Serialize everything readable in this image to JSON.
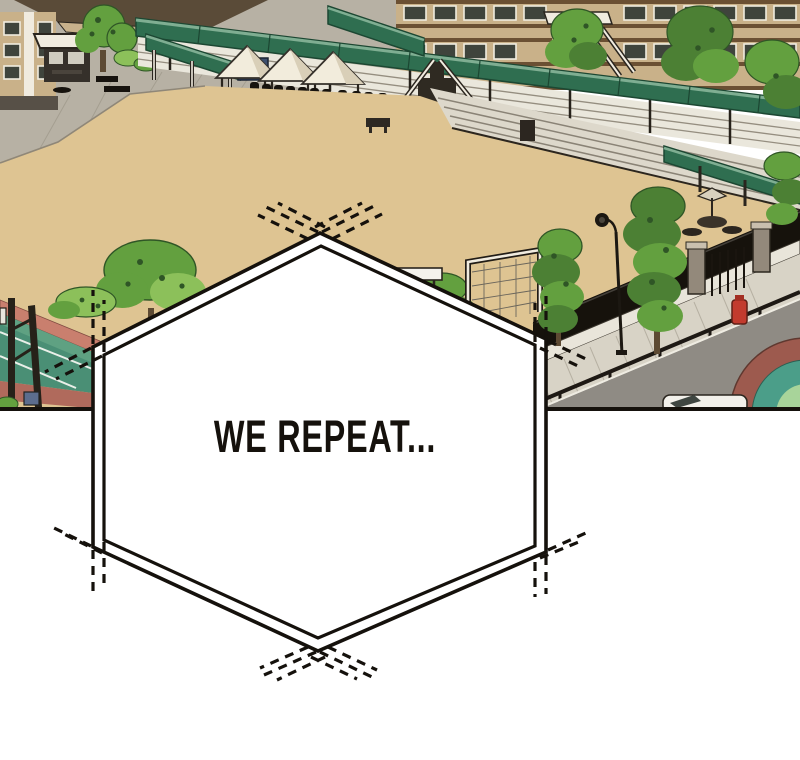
{
  "panel": {
    "caption": "WE REPEAT...",
    "scene_label": "school sports field with street"
  },
  "colors": {
    "paper": "#ffffff",
    "ink": "#15110c",
    "sand": "#dec492",
    "pavement": "#b7b1a4",
    "pavementLine": "#a09a8c",
    "roofBrown": "#5a4b38",
    "roofLight": "#c8b18b",
    "buildingTan": "#c9b189",
    "buildingBand": "#6b5033",
    "buildingBase": "#575047",
    "windowDark": "#3f443c",
    "trimWhite": "#f0ebdf",
    "canopyGreen": "#2f6e50",
    "canopyDark": "#1c4732",
    "canopyLight": "#7fae92",
    "treeGreen": "#63a03f",
    "treeDark": "#2f5526",
    "cypressGreen": "#4c8034",
    "leafLight": "#8cc05a",
    "plank": "#eae7dc",
    "plankLine": "#958e80",
    "step": "#ddd8cb",
    "stepLine": "#8a8376",
    "crowd": "#17130e",
    "tent": "#f2ecdc",
    "tentShade": "#d9cfb8",
    "board": "#3d4f6e",
    "trackRed": "#c97f6e",
    "trackRedDark": "#b06a5c",
    "courtTeal": "#4a8f75",
    "courtLight": "#5fa182",
    "lineWhite": "#e9efe8",
    "fenceDark": "#16120c",
    "wall": "#e9e5da",
    "sidewalk": "#d8d3c6",
    "sidewalkLine": "#b6b0a2",
    "road": "#8f8b84",
    "curb": "#efece2",
    "ringBrick": "#9d5a4e",
    "ringTeal": "#4b9e89",
    "ringGreen": "#a8d49a",
    "car": "#f2f0ea",
    "glass": "#3f4641",
    "hydrant": "#c23b2e",
    "white": "#f4f2ec",
    "dark": "#2a251e",
    "steel": "#93897b",
    "trunk": "#5d4a33",
    "boxBlue": "#5c6d8e"
  }
}
